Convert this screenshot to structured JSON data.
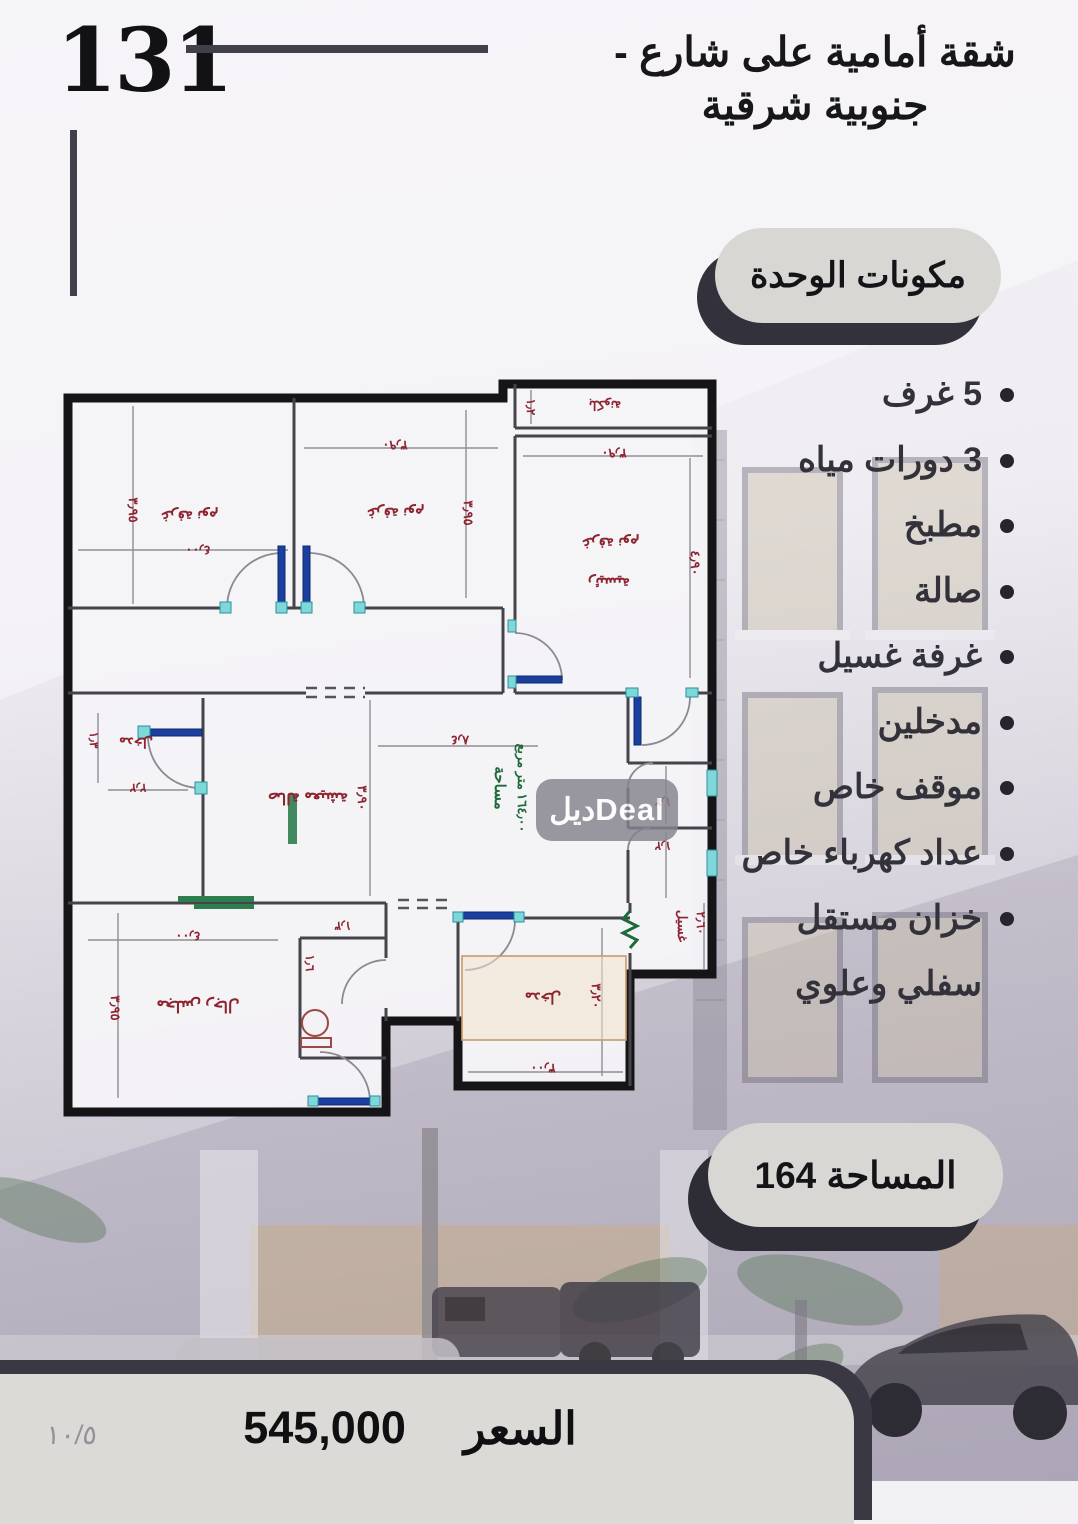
{
  "unit_number": "131",
  "title": {
    "line1": "شقة أمامية على شارع -",
    "line2": "جنوبية شرقية"
  },
  "components": {
    "heading": "مكونات الوحدة",
    "items": [
      "5 غرف",
      "3 دورات مياه",
      "مطبخ",
      "صالة",
      "غرفة غسيل",
      "مدخلين",
      "موقف خاص",
      "عداد كهرباء خاص",
      "خزان مستقل سفلي وعلوي"
    ]
  },
  "area_pill": "المساحة 164",
  "price": {
    "label": "السعر",
    "value": "545,000"
  },
  "page_indicator": "١٠/٥",
  "watermark": "ديلDeal",
  "floor_plan": {
    "area_note": {
      "word": "مساحة",
      "value": "١٦٤٫٠٠ متر مربع"
    },
    "rooms": [
      {
        "name": "bedroom-top-left",
        "label": "غرفة نوم",
        "dims": [
          "٣٫٩٥",
          "٤٫٠٠"
        ]
      },
      {
        "name": "bedroom-top-middle",
        "label": "غرفة نوم",
        "dims": [
          "٣٫٩٠",
          "٣٫٩٥"
        ]
      },
      {
        "name": "balcony",
        "label": "بلكونة",
        "dims": [
          "١٫٢"
        ]
      },
      {
        "name": "master-bedroom",
        "label": "غرفة نوم",
        "label2": "رئيسية",
        "dims": [
          "٣٫٩٠",
          "٤٫٩٠"
        ]
      },
      {
        "name": "entry-left",
        "label": "مدخل",
        "dims": [
          "١٫٣",
          "٢٫٢"
        ]
      },
      {
        "name": "living-hall",
        "label": "صالة معيشة",
        "dims": [
          "٣٫٩٠",
          "٨٫٤"
        ]
      },
      {
        "name": "bath-1",
        "dims": [
          "١٫٢"
        ]
      },
      {
        "name": "bath-2",
        "dims": [
          "١٫٢"
        ]
      },
      {
        "name": "laundry",
        "label": "غسيل",
        "dims": [
          "٢٫٦٠"
        ]
      },
      {
        "name": "majlis",
        "label": "مجلس رجال",
        "dims": [
          "٤٫٠٠",
          "٣٫٩٥"
        ]
      },
      {
        "name": "wc",
        "dims": [
          "١٫٣",
          "١٫٦"
        ]
      },
      {
        "name": "entrance",
        "label": "مدخل",
        "dims": [
          "٣٫٢٠",
          "٣٫٠٠"
        ]
      }
    ]
  },
  "colors": {
    "accent_dark": "#393843",
    "pill_bg": "#d9d7d3",
    "plan_red": "#8e2430",
    "plan_green": "#1d6b3a",
    "plan_cyan": "#7fd8d8",
    "plan_blue": "#1b3f9e"
  }
}
